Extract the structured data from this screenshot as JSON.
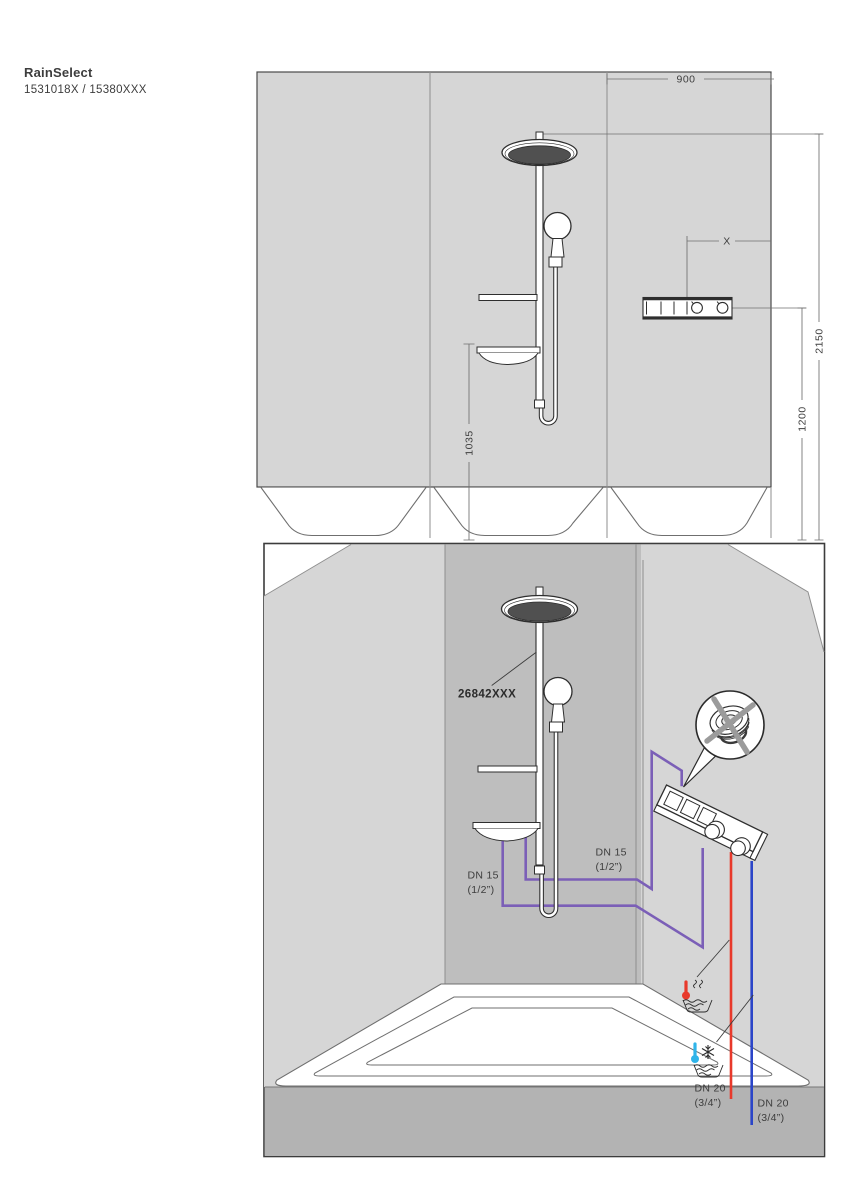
{
  "header": {
    "product_name": "RainSelect",
    "product_codes": "1531018X / 15380XXX"
  },
  "front_view": {
    "description": "front installation drawing with dimensions in mm",
    "dimensions": {
      "width": "900",
      "center_offset": "X",
      "total_height": "2150",
      "valve_height": "1200",
      "shelf_height": "1035"
    }
  },
  "perspective_view": {
    "description": "perspective installation drawing with pipe routing",
    "part_number": "26842XXX",
    "pipe_labels": [
      {
        "id": "dn15-left",
        "line1": "DN 15",
        "line2": "(1/2”)"
      },
      {
        "id": "dn15-right",
        "line1": "DN 15",
        "line2": "(1/2”)"
      },
      {
        "id": "dn20-hot",
        "line1": "DN 20",
        "line2": "(3/4”)"
      },
      {
        "id": "dn20-cold",
        "line1": "DN 20",
        "line2": "(3/4”)"
      }
    ]
  },
  "colors": {
    "mixed_water_pipe": "#7B5FB7",
    "hot_water_pipe": "#E8392B",
    "cold_water_pipe": "#2B45C8",
    "cold_thermometer": "#2FB4E9",
    "wall_light": "#D6D6D6",
    "wall_back": "#BEBEBE",
    "floor": "#B3B3B3",
    "crossed_out": "#9B9B9B"
  }
}
